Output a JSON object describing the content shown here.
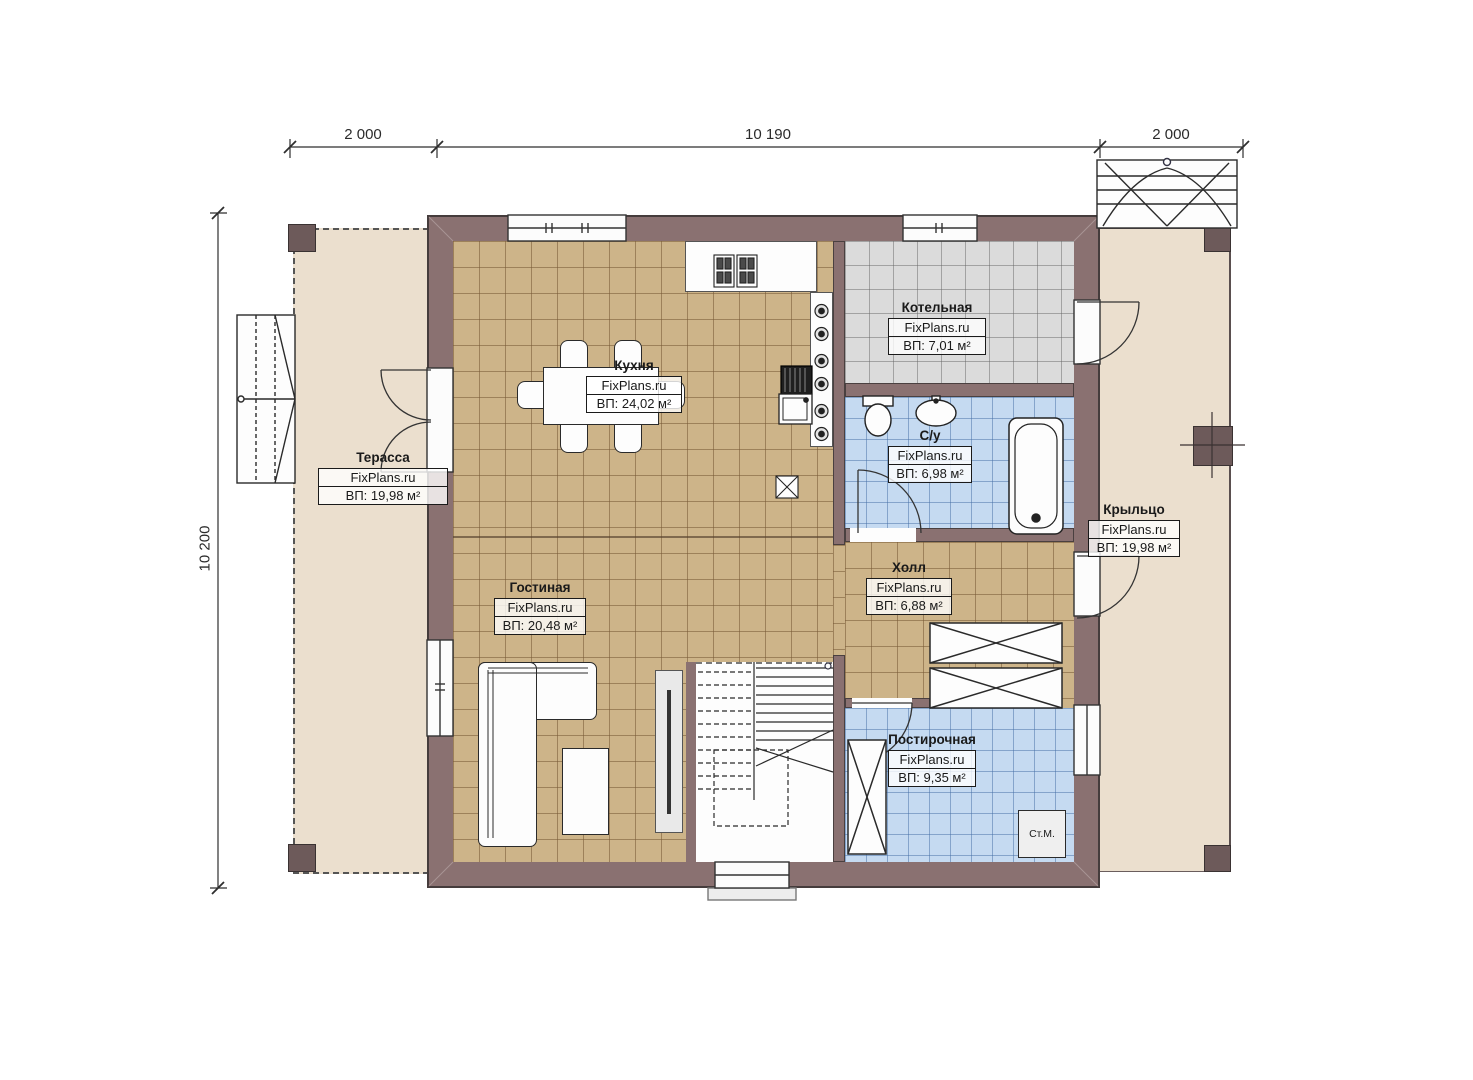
{
  "plan": {
    "dimensions": {
      "top_left": "2 000",
      "top_center": "10 190",
      "top_right": "2 000",
      "left": "10 200"
    },
    "rooms": {
      "terrace": {
        "name": "Терасса",
        "brand": "FixPlans.ru",
        "area": "ВП: 19,98 м²"
      },
      "kitchen": {
        "name": "Кухня",
        "brand": "FixPlans.ru",
        "area": "ВП: 24,02 м²"
      },
      "boiler": {
        "name": "Котельная",
        "brand": "FixPlans.ru",
        "area": "ВП: 7,01 м²"
      },
      "bathroom": {
        "name": "С/у",
        "brand": "FixPlans.ru",
        "area": "ВП: 6,98 м²"
      },
      "porch": {
        "name": "Крыльцо",
        "brand": "FixPlans.ru",
        "area": "ВП: 19,98 м²"
      },
      "hall": {
        "name": "Холл",
        "brand": "FixPlans.ru",
        "area": "ВП: 6,88 м²"
      },
      "living": {
        "name": "Гостиная",
        "brand": "FixPlans.ru",
        "area": "ВП: 20,48 м²"
      },
      "laundry": {
        "name": "Постирочная",
        "brand": "FixPlans.ru",
        "area": "ВП: 9,35 м²"
      }
    },
    "appliances": {
      "washing_machine_label": "Ст.М."
    },
    "colors": {
      "wall": "#8a7171",
      "terrace_floor": "#ebdfce",
      "tan_tile": "#cdb489",
      "gray_tile": "#dbdbdb",
      "blue_tile": "#c5daf1"
    }
  }
}
